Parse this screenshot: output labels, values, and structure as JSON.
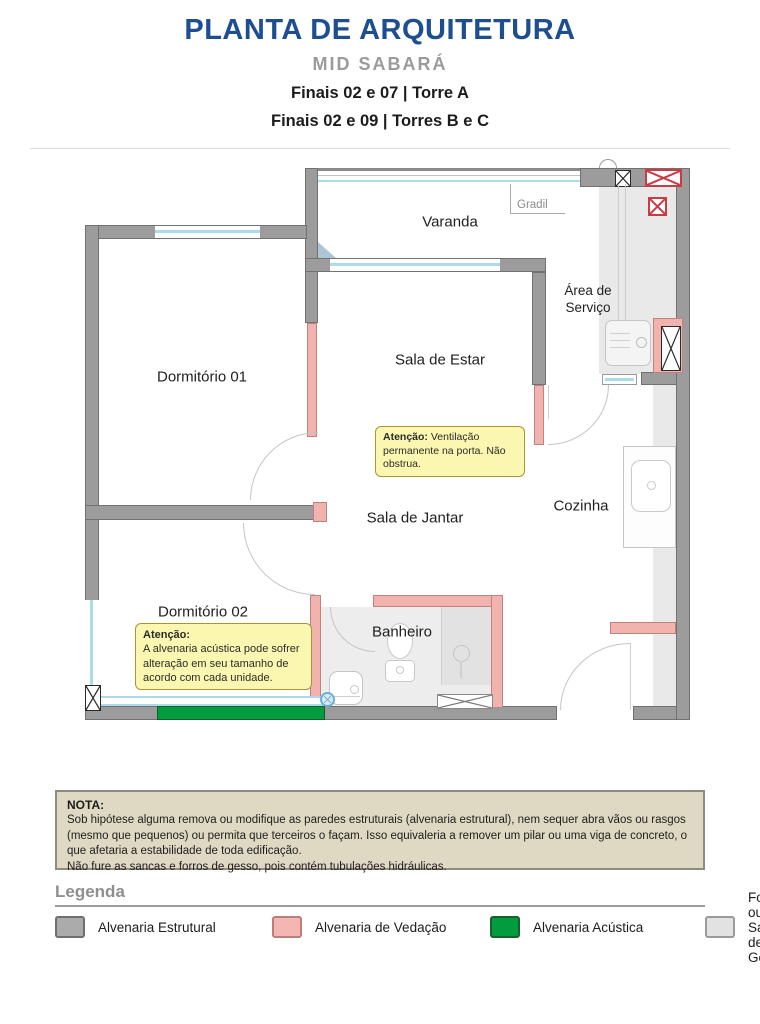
{
  "header": {
    "title": "PLANTA DE ARQUITETURA",
    "subtitle": "MID SABARÁ",
    "line1": "Finais 02 e 07  |  Torre A",
    "line2": "Finais 02 e 09  |  Torres B e C"
  },
  "plan": {
    "labels": {
      "varanda": "Varanda",
      "gradil": "Gradil",
      "area_servico": "Área de Serviço",
      "sala_estar": "Sala de Estar",
      "dormitorio_01": "Dormitório 01",
      "sala_jantar": "Sala de Jantar",
      "cozinha": "Cozinha",
      "dormitorio_02": "Dormitório 02",
      "banheiro": "Banheiro"
    },
    "notes": {
      "door": {
        "title": "Atenção:",
        "text": "Ventilação permanente na porta. Não obstrua."
      },
      "acoustic": {
        "title": "Atenção:",
        "text": "A alvenaria acústica pode sofrer alteração em seu tamanho de acordo com cada unidade."
      }
    }
  },
  "nota": {
    "title": "NOTA:",
    "p1": "Sob hipótese alguma remova ou modifique as paredes estruturais (alvenaria estrutural), nem sequer abra vãos ou rasgos (mesmo que pequenos) ou permita que terceiros o façam. Isso equivaleria a remover um pilar ou uma viga de concreto, o que afetaria a estabilidade de toda edificação.",
    "p2": "Não fure as sancas e forros de gesso, pois contém tubulações hidráulicas."
  },
  "legend": {
    "heading": "Legenda",
    "items": [
      {
        "label": "Alvenaria Estrutural",
        "color": "#ababab",
        "kind": "solid"
      },
      {
        "label": "Alvenaria de Vedação",
        "color": "#f5b5b0",
        "kind": "solid"
      },
      {
        "label": "Alvenaria Acústica",
        "color": "#009c3d",
        "kind": "solid"
      },
      {
        "label": "Forro ou Sanca de Gesso",
        "color": "#e2e2e2",
        "kind": "solid"
      },
      {
        "label": "Enchimento",
        "color": "#aec5d5",
        "kind": "solid"
      },
      {
        "label": "Exaustão Mecânica",
        "color": "#74aed3",
        "kind": "double-line"
      },
      {
        "label": "Vazio/ Shaft",
        "color": "#b5b5b5",
        "kind": "x-box"
      },
      {
        "label": "Furo",
        "color": "#2a2a2a",
        "kind": "x-box"
      },
      {
        "label": "Ventilação Permanente (Não Obstrua)",
        "color": "#cc3b44",
        "kind": "x-box"
      }
    ]
  },
  "colors": {
    "title_blue": "#1d4e91",
    "subtitle_gray": "#9b9b9b",
    "wall_structural": "#9c9c9c",
    "wall_vedacao": "#f2b2ad",
    "wall_acustica": "#009c3d",
    "forro_shade": "#e9e9e9",
    "enchimento": "#aec5d5",
    "window_blue": "#aadcec",
    "note_yellow": "#fbf7b0",
    "nota_beige": "#dfd9c3",
    "x_red": "#cc3b44"
  }
}
